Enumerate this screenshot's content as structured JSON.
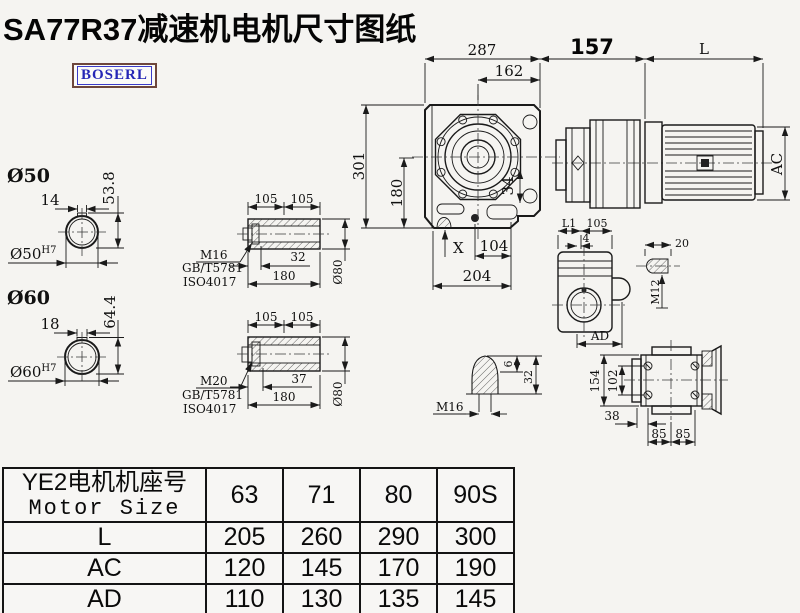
{
  "title": "SA77R37减速机电机尺寸图纸",
  "logo": "BOSERL",
  "main_view": {
    "dim_287": "287",
    "dim_162": "162",
    "dim_157": "157",
    "dim_L": "L",
    "dim_AC": "AC",
    "dim_301": "301",
    "dim_180": "180",
    "dim_34": "34",
    "label_X": "X",
    "dim_104": "104",
    "dim_204": "204"
  },
  "shaft50": {
    "label": "Ø50",
    "key_width": "14",
    "height": "53.8",
    "bore": "Ø50",
    "tolerance": "H7"
  },
  "shaft60": {
    "label": "Ø60",
    "key_width": "18",
    "height": "64.4",
    "bore": "Ø60",
    "tolerance": "H7"
  },
  "hollow_shaft_top": {
    "dim_105_left": "105",
    "dim_105_right": "105",
    "dim_depth": "32",
    "dim_length": "180",
    "dim_dia": "Ø80",
    "bolt": "M16",
    "standard_1": "GB/T5781",
    "standard_2": "ISO4017"
  },
  "hollow_shaft_bottom": {
    "dim_105_left": "105",
    "dim_105_right": "105",
    "dim_depth": "37",
    "dim_length": "180",
    "dim_dia": "Ø80",
    "bolt": "M20",
    "standard_1": "GB/T5781",
    "standard_2": "ISO4017"
  },
  "end_view": {
    "dim_L1": "L1",
    "dim_105": "105",
    "dim_4": "4",
    "dim_AD": "AD"
  },
  "key_detail": {
    "dim_20": "20",
    "thread": "M12"
  },
  "plug_detail": {
    "thread": "M16",
    "dim_6": "6",
    "dim_32": "32"
  },
  "flange_view": {
    "dim_154": "154",
    "dim_102": "102",
    "dim_38": "38",
    "dim_85_left": "85",
    "dim_85_right": "85"
  },
  "table": {
    "header_cn": "YE2电机机座号",
    "header_en": "Motor Size",
    "columns": [
      "63",
      "71",
      "80",
      "90S"
    ],
    "rows": [
      {
        "label": "L",
        "values": [
          "205",
          "260",
          "290",
          "300"
        ]
      },
      {
        "label": "AC",
        "values": [
          "120",
          "145",
          "170",
          "190"
        ]
      },
      {
        "label": "AD",
        "values": [
          "110",
          "130",
          "135",
          "145"
        ]
      }
    ]
  }
}
